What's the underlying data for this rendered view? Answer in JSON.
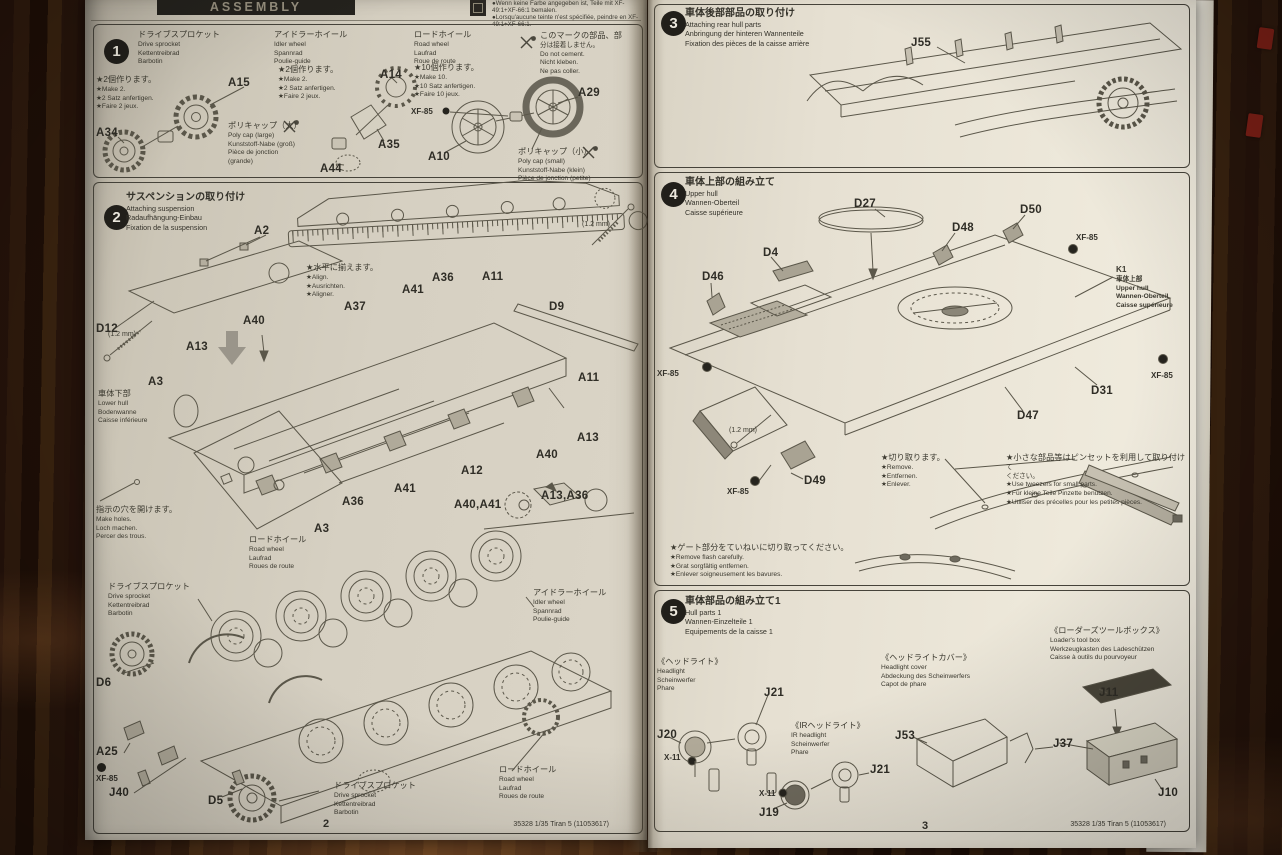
{
  "colors": {
    "paper_left": "#d3cdbf",
    "paper_right": "#e9e4d6",
    "ink": "#3b392f",
    "wood_dark": "#2b1609",
    "red_edge_tab": "#7c1f16",
    "line_art": "#5b574a"
  },
  "header": {
    "assembly": "ASSEMBLY",
    "paint_note": "●Wenn keine Farbe angegeben ist, Teile mit XF-49:1+XF-66:1 bemalen.\n●Lorsqu'aucune teinte n'est spécifiée, peindre en XF-49:1+XF-66:1."
  },
  "footer": {
    "code": "35328 1/35 Tiran 5 (11053617)",
    "left_page": "2",
    "right_page": "3"
  },
  "step1": {
    "number": "1",
    "drive_sprocket": "ドライブスプロケット\nDrive sprocket\nKettentreibrad\nBarbotin",
    "drive_make": "★2個作ります。\n★Make 2.\n★2 Satz anfertigen.\n★Faire 2 jeux.",
    "idler_wheel": "アイドラーホイール\nIdler wheel\nSpannrad\nPoulie-guide",
    "idler_make": "★2個作ります。\n★Make 2.\n★2 Satz anfertigen.\n★Faire 2 jeux.",
    "road_wheel": "ロードホイール\nRoad wheel\nLaufrad\nRoue de route",
    "road_make": "★10個作ります。\n★Make 10.\n★10 Satz anfertigen.\n★Faire 10 jeux.",
    "no_cement": "このマークの部品、部\n分は接着しません。\nDo not cement.\nNicht kleben.\nNe pas coller.",
    "poly_cap_large": "ポリキャップ（大）\nPoly cap (large)\nKunststoff-Nabe (groß)\nPièce de jonction\n(grande)",
    "poly_cap_small": "ポリキャップ（小）\nPoly cap (small)\nKunststoff-Nabe (klein)\nPièce de jonction (petite)",
    "parts": {
      "a15": "A15",
      "a34": "A34",
      "a44": "A44",
      "a35": "A35",
      "a14": "A14",
      "a10": "A10",
      "a29": "A29",
      "xf85": "XF-85"
    }
  },
  "step2": {
    "number": "2",
    "title": "サスペンションの取り付け\nAttaching suspension\nRadaufhängung-Einbau\nFixation de la suspension",
    "align_note": "★水平に揃えます。\n★Align.\n★Ausrichten.\n★Aligner.",
    "lower_hull": "車体下部\nLower hull\nBodenwanne\nCaisse inférieure",
    "make_holes": "指示の穴を開けます。\nMake holes.\nLoch machen.\nPercer des trous.",
    "road_wheel_callout": "ロードホイール\nRoad wheel\nLaufrad\nRoues de route",
    "idler_callout": "アイドラーホイール\nIdler wheel\nSpannrad\nPoulie-guide",
    "drive_sprocket_callout": "ドライブスプロケット\nDrive sprocket\nKettentreibrad\nBarbotin",
    "mm": "(1.2 mm)",
    "parts": {
      "a2": "A2",
      "d12": "D12",
      "a40": "A40",
      "a13": "A13",
      "a3": "A3",
      "a37": "A37",
      "a41": "A41",
      "a36": "A36",
      "a11": "A11",
      "d9": "D9",
      "a12": "A12",
      "a40a41": "A40,A41",
      "a13a36": "A13,A36",
      "d6": "D6",
      "a25": "A25",
      "j40": "J40",
      "d5": "D5",
      "xf85": "XF-85"
    }
  },
  "step3": {
    "number": "3",
    "title": "車体後部部品の取り付け\nAttaching rear hull parts\nAnbringung der hinteren Wannenteile\nFixation des pièces de la caisse arrière",
    "parts": {
      "j55": "J55"
    }
  },
  "step4": {
    "number": "4",
    "title": "車体上部の組み立て\nUpper hull\nWannen-Oberteil\nCaisse supérieure",
    "k1": "K1\n車体上部\nUpper hull\nWannen-Oberteil\nCaisse supérieure",
    "remove_note": "★切り取ります。\n★Remove.\n★Entfernen.\n★Enlever.",
    "tweezers_note": "★小さな部品等はピンセットを利用して取り付けて\nください。\n★Use tweezers for small parts.\n★Für kleine Teile Pinzette benutzen.\n★Utiliser des précelles pour les petites pièces.",
    "flash_note": "★ゲート部分をていねいに切り取ってください。\n★Remove flash carefully.\n★Grat sorgfältig entfernen.\n★Enlever soigneusement les bavures.",
    "mm": "(1.2 mm)",
    "parts": {
      "d27": "D27",
      "d48": "D48",
      "d50": "D50",
      "d4": "D4",
      "d46": "D46",
      "d31": "D31",
      "d47": "D47",
      "d49": "D49",
      "xf85": "XF-85"
    }
  },
  "step5": {
    "number": "5",
    "title": "車体部品の組み立て1\nHull parts 1\nWannen-Einzelteile 1\nEquipements de la caisse 1",
    "headlight": "《ヘッドライト》\nHeadlight\nScheinwerfer\nPhare",
    "headlight_cover": "《ヘッドライトカバー》\nHeadlight cover\nAbdeckung des Scheinwerfers\nCapot de phare",
    "ir_headlight": "《IRヘッドライト》\nIR headlight\nScheinwerfer\nPhare",
    "tool_box": "《ローダーズツールボックス》\nLoader's tool box\nWerkzeugkasten des Ladeschützen\nCaisse à outils du pourvoyeur",
    "parts": {
      "j20": "J20",
      "j21": "J21",
      "j19": "J19",
      "j53": "J53",
      "j37": "J37",
      "j11": "J11",
      "j10": "J10",
      "x11": "X-11"
    }
  }
}
